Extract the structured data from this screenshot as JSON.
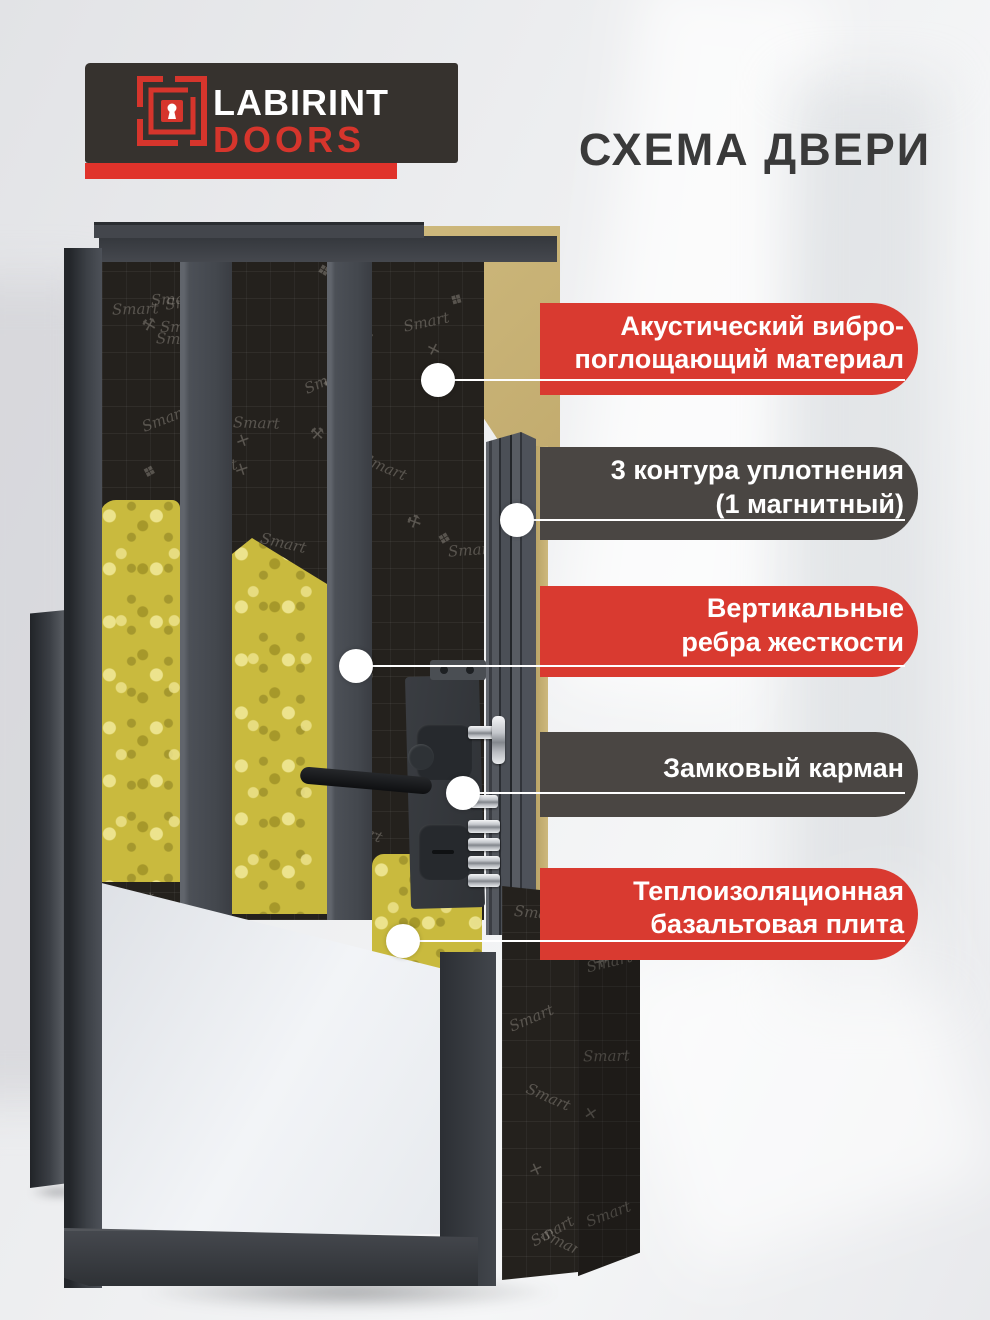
{
  "header": {
    "logo": {
      "line1": "LABIRINT",
      "line2": "DOORS"
    },
    "title": "СХЕМА ДВЕРИ"
  },
  "callouts": [
    {
      "line1": "Акустический вибро-",
      "line2": "поглощающий материал",
      "variant": "red"
    },
    {
      "line1": "3 контура уплотнения",
      "line2": "(1 магнитный)",
      "variant": "dark"
    },
    {
      "line1": "Вертикальные",
      "line2": "ребра жесткости",
      "variant": "red"
    },
    {
      "line1": "Замковый карман",
      "line2": "",
      "variant": "dark"
    },
    {
      "line1": "Теплоизоляционная",
      "line2": "базальтовая плита",
      "variant": "red"
    }
  ],
  "diagram": {
    "pattern_brand": "Smart",
    "parts": [
      "каркас двери",
      "акустический материал",
      "минеральная вата",
      "замок",
      "уплотнители",
      "внутренняя панель"
    ]
  },
  "colors": {
    "accent_red": "#d93a30",
    "pill_dark": "#4a4643",
    "logo_bg": "#36322e",
    "logo_red": "#d6352c",
    "tan_cut": "#c7b175",
    "wool_yellow": "#c9ba3e",
    "title_text": "#3a3a3a",
    "frame_gray": "#3c4046"
  }
}
